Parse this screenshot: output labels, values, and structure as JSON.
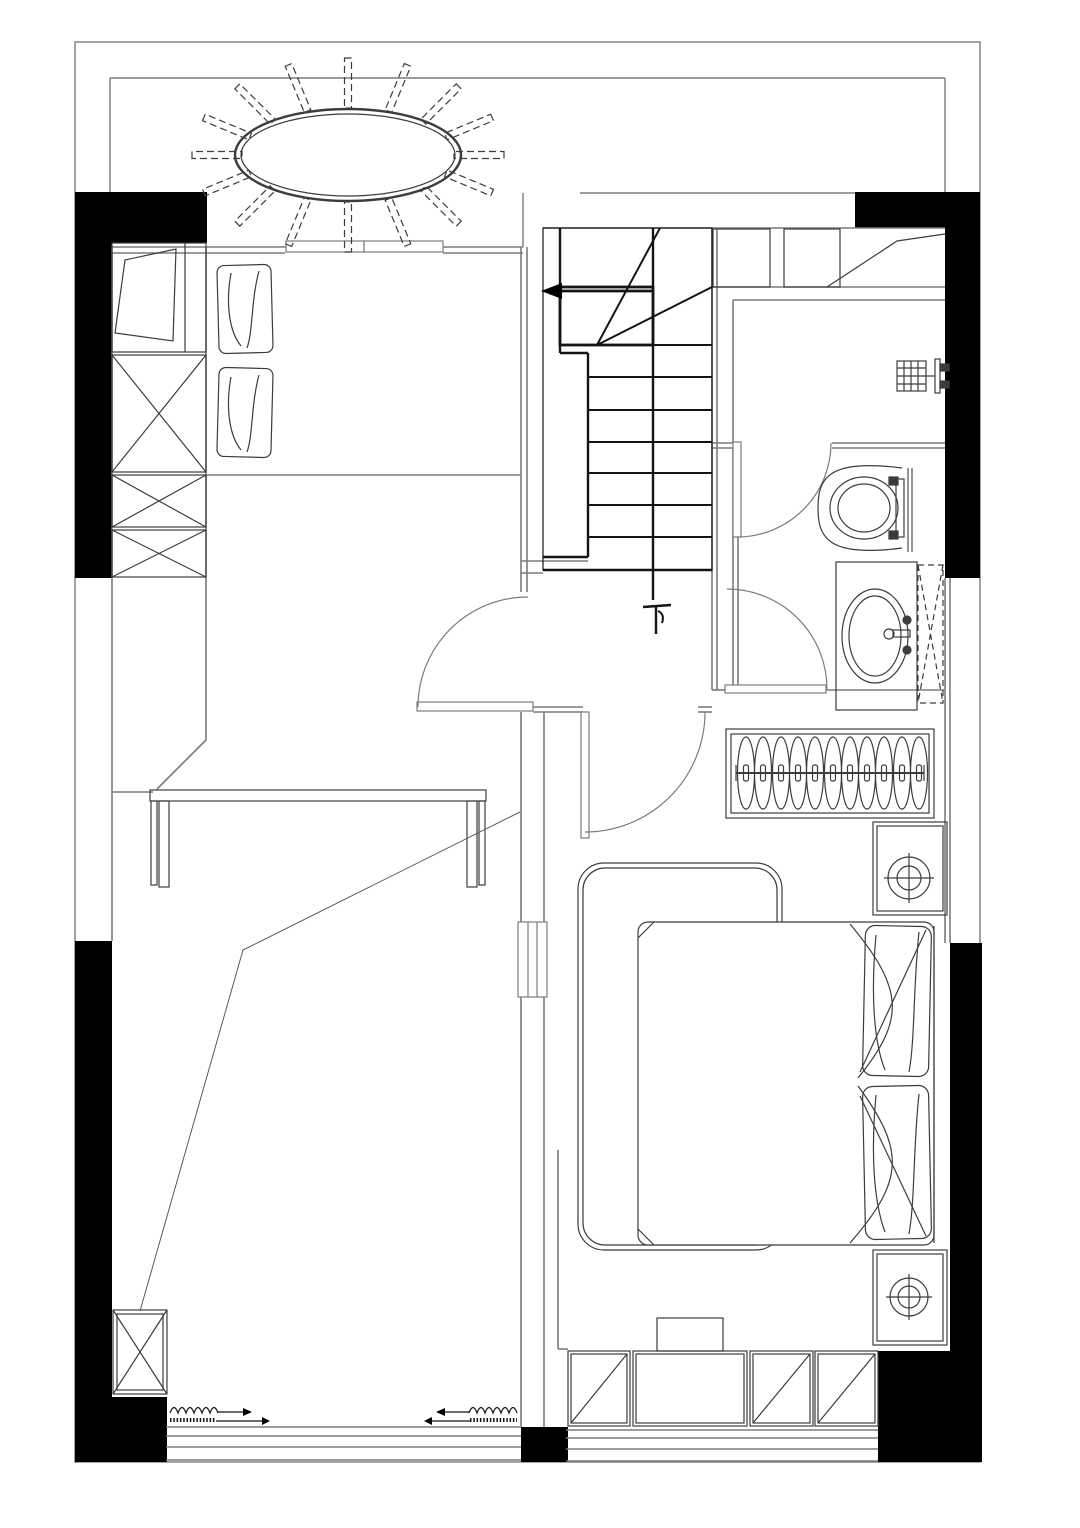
{
  "plan": {
    "stair_label": "下",
    "colors": {
      "background": "#ffffff",
      "wall_fill": "#000000",
      "wall_line": "#7b7b7b",
      "furniture_line": "#3c3c3c",
      "stair_line": "#141414",
      "sketch_line": "#5a5a5a"
    },
    "fixtures": [
      "ceiling-fan-light",
      "single-bed-with-pillows",
      "wardrobe-crossed-boxes",
      "desk",
      "staircase-down",
      "shower-head",
      "toilet",
      "sink-vanity",
      "mirror-cabinet",
      "hanging-rail-wardrobe",
      "double-bed",
      "nightstand-lamps",
      "foot-bench",
      "low-cabinets",
      "sliding-window-curtains"
    ]
  }
}
